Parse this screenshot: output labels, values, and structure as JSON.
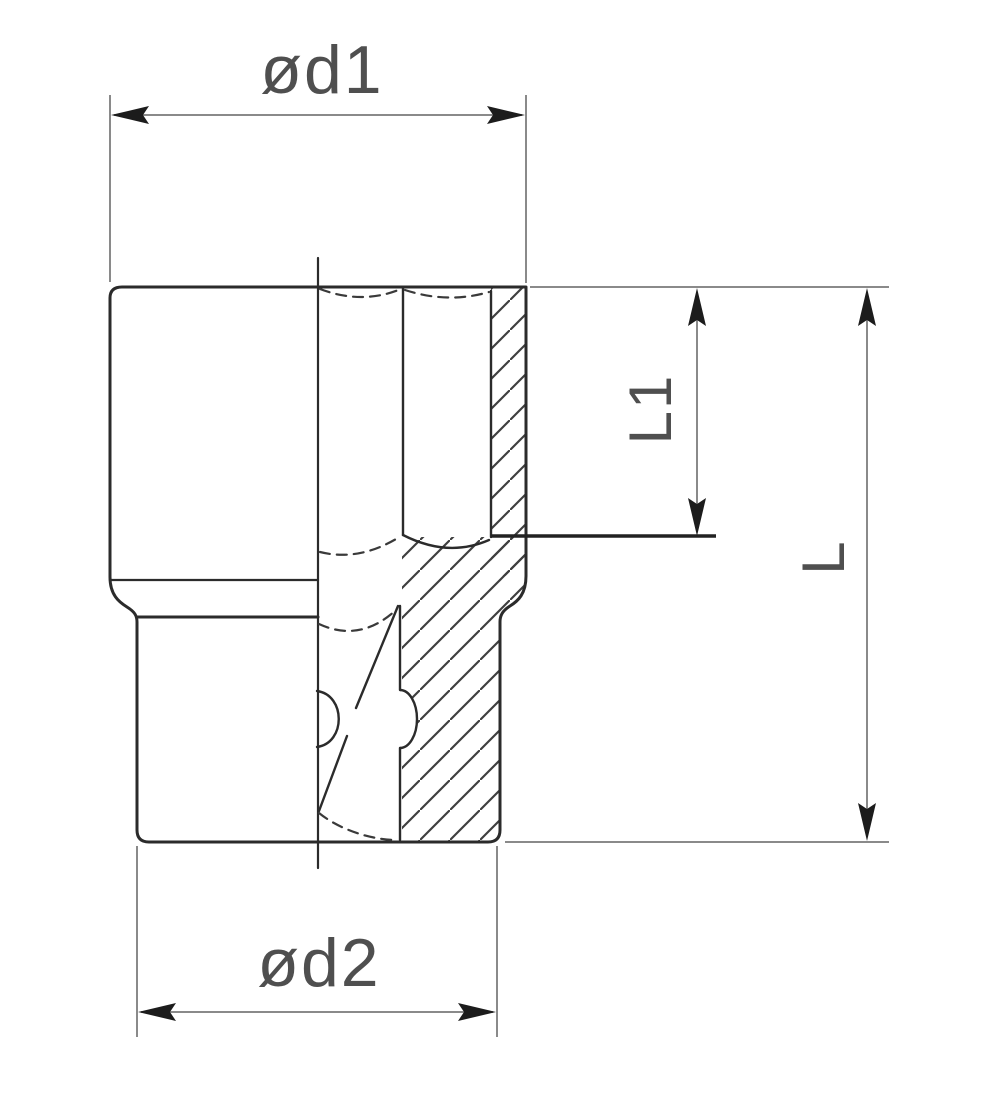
{
  "drawing": {
    "title": "Socket cross-section technical drawing",
    "labels": {
      "d1": "ød1",
      "d2": "ød2",
      "l1": "L1",
      "l": "L"
    },
    "colors": {
      "background": "#ffffff",
      "outline": "#2b2b2b",
      "dimension": "#8a8a8a",
      "arrow": "#1c1c1c",
      "hatch": "#3f3f3f",
      "text": "#4f4f4f"
    }
  }
}
